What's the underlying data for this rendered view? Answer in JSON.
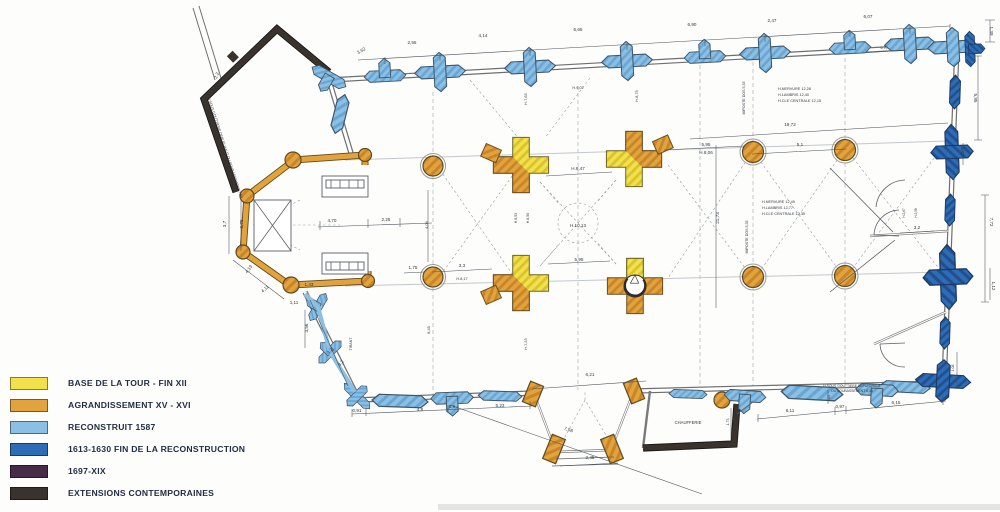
{
  "title": "Plan phasé d'une église (relevé archéologique)",
  "legend": {
    "items": [
      {
        "color": "#f2e14b",
        "label": "BASE DE LA TOUR - FIN XII"
      },
      {
        "color": "#e2a23c",
        "label": "AGRANDISSEMENT XV - XVI"
      },
      {
        "color": "#8bbfe3",
        "label": "RECONSTRUIT 1587"
      },
      {
        "color": "#2e6cb5",
        "label": "1613-1630 FIN DE LA RECONSTRUCTION"
      },
      {
        "color": "#472c48",
        "label": "1697-XIX"
      },
      {
        "color": "#39322d",
        "label": "EXTENSIONS CONTEMPORAINES"
      }
    ]
  },
  "plan": {
    "room_label": "CHAUFFERIE",
    "texts": [
      {
        "x": 362,
        "y": 52,
        "r": -30,
        "t": "3,52"
      },
      {
        "x": 412,
        "y": 44,
        "t": "2,55"
      },
      {
        "x": 483,
        "y": 37,
        "t": "4,14"
      },
      {
        "x": 578,
        "y": 31,
        "t": "6,65"
      },
      {
        "x": 692,
        "y": 26,
        "t": "6,90"
      },
      {
        "x": 772,
        "y": 22,
        "t": "2,47"
      },
      {
        "x": 868,
        "y": 18,
        "t": "6,07"
      },
      {
        "x": 990,
        "y": 31,
        "r": 90,
        "t": "1,39"
      },
      {
        "x": 974,
        "y": 98,
        "r": 90,
        "t": "5,95"
      },
      {
        "x": 218,
        "y": 76,
        "r": -68,
        "t": "2,2"
      },
      {
        "x": 224,
        "y": 148,
        "r": 72,
        "s": 3.6,
        "t": "H SOUS GOUTTIERE DEPUIS HAUT DU SOUBASSEMENT 7,80"
      },
      {
        "x": 790,
        "y": 126,
        "t": "19,72"
      },
      {
        "x": 800,
        "y": 146,
        "t": "5,1"
      },
      {
        "x": 961,
        "y": 152,
        "r": 90,
        "t": "1,02"
      },
      {
        "x": 990,
        "y": 222,
        "r": 90,
        "t": "7,72"
      },
      {
        "x": 917,
        "y": 229,
        "t": "3,2"
      },
      {
        "x": 992,
        "y": 286,
        "r": 90,
        "t": "1,12"
      },
      {
        "x": 778,
        "y": 90,
        "s": 3.8,
        "a": "s",
        "t": "H.NERVURE 12,28"
      },
      {
        "x": 778,
        "y": 96,
        "s": 3.8,
        "a": "s",
        "t": "H.LAMBRIS 12,40"
      },
      {
        "x": 778,
        "y": 102,
        "s": 3.8,
        "a": "s",
        "t": "H.CLE CENTRALE 12,15"
      },
      {
        "x": 762,
        "y": 203,
        "s": 3.8,
        "a": "s",
        "t": "H.NERVURE 12,49"
      },
      {
        "x": 762,
        "y": 209,
        "s": 3.8,
        "a": "s",
        "t": "H.LAMBRIS 12,77"
      },
      {
        "x": 762,
        "y": 215,
        "s": 3.8,
        "a": "s",
        "t": "H.CLE CENTRALE 12,35"
      },
      {
        "x": 745,
        "y": 98,
        "r": -90,
        "s": 3.6,
        "t": "IMPOSTE DOS 5,35"
      },
      {
        "x": 748,
        "y": 237,
        "r": -90,
        "s": 3.6,
        "t": "IMPOSTE DOS 5,35"
      },
      {
        "x": 578,
        "y": 170,
        "t": "H.8,47"
      },
      {
        "x": 578,
        "y": 227,
        "t": "H.10,13"
      },
      {
        "x": 579,
        "y": 261,
        "t": "5,95"
      },
      {
        "x": 706,
        "y": 146,
        "t": "5,95"
      },
      {
        "x": 706,
        "y": 154,
        "t": "H.8,06"
      },
      {
        "x": 719,
        "y": 218,
        "r": -90,
        "t": "21,73"
      },
      {
        "x": 517,
        "y": 218,
        "r": -90,
        "s": 3.6,
        "t": "H.8,53"
      },
      {
        "x": 529,
        "y": 218,
        "r": -90,
        "s": 3.6,
        "t": "H.8,50"
      },
      {
        "x": 527,
        "y": 99,
        "r": -90,
        "s": 3.8,
        "t": "H.7,63"
      },
      {
        "x": 638,
        "y": 96,
        "r": -90,
        "s": 3.8,
        "t": "H.8,75"
      },
      {
        "x": 578,
        "y": 89,
        "s": 3.8,
        "t": "H.9,02"
      },
      {
        "x": 332,
        "y": 222,
        "t": "4,70"
      },
      {
        "x": 386,
        "y": 221,
        "t": "2,25"
      },
      {
        "x": 428,
        "y": 225,
        "r": -90,
        "s": 3.8,
        "t": "4,05"
      },
      {
        "x": 413,
        "y": 269,
        "t": "1,75"
      },
      {
        "x": 462,
        "y": 267,
        "t": "3,3"
      },
      {
        "x": 462,
        "y": 280,
        "s": 3.8,
        "t": "H.8,17"
      },
      {
        "x": 226,
        "y": 224,
        "r": -90,
        "t": "3,7"
      },
      {
        "x": 243,
        "y": 224,
        "r": -90,
        "t": "2,76"
      },
      {
        "x": 250,
        "y": 270,
        "r": -55,
        "t": "4,13"
      },
      {
        "x": 266,
        "y": 290,
        "r": -42,
        "t": "4,11"
      },
      {
        "x": 309,
        "y": 286,
        "t": "1,43"
      },
      {
        "x": 294,
        "y": 304,
        "t": "1,11"
      },
      {
        "x": 308,
        "y": 328,
        "r": -90,
        "t": "3,56"
      },
      {
        "x": 331,
        "y": 352,
        "r": -48,
        "t": "3,2"
      },
      {
        "x": 342,
        "y": 364,
        "r": -48,
        "t": "3,2"
      },
      {
        "x": 357,
        "y": 412,
        "t": "0,91"
      },
      {
        "x": 420,
        "y": 411,
        "t": "4,8"
      },
      {
        "x": 452,
        "y": 408,
        "t": "0,9"
      },
      {
        "x": 500,
        "y": 407,
        "t": "5,23"
      },
      {
        "x": 568,
        "y": 431,
        "r": 18,
        "t": "7,58"
      },
      {
        "x": 590,
        "y": 376,
        "t": "6,21"
      },
      {
        "x": 590,
        "y": 459,
        "t": "2,45"
      },
      {
        "x": 688,
        "y": 424,
        "s": 4.2,
        "t": "CHAUFFERIE"
      },
      {
        "x": 729,
        "y": 422,
        "r": -90,
        "s": 3.6,
        "t": "1,73"
      },
      {
        "x": 352,
        "y": 344,
        "r": -90,
        "s": 3.6,
        "t": "TIRANT"
      },
      {
        "x": 790,
        "y": 412,
        "t": "6,11"
      },
      {
        "x": 840,
        "y": 408,
        "t": "0,97"
      },
      {
        "x": 896,
        "y": 404,
        "t": "6,15"
      },
      {
        "x": 954,
        "y": 368,
        "r": -90,
        "s": 3.6,
        "t": "1,08"
      },
      {
        "x": 830,
        "y": 398,
        "r": -90,
        "s": 3.2,
        "t": "1,05"
      },
      {
        "x": 852,
        "y": 387,
        "s": 3.4,
        "t": "H SOUS GOUTTIERE DEPUIS HAUT"
      },
      {
        "x": 852,
        "y": 392,
        "s": 3.4,
        "t": "DU SOUBASSEMENT 8,44"
      },
      {
        "x": 884,
        "y": 49,
        "s": 3.6,
        "t": "6,70"
      },
      {
        "x": 527,
        "y": 344,
        "r": -90,
        "s": 3.8,
        "t": "H.7,23"
      },
      {
        "x": 430,
        "y": 330,
        "r": -90,
        "s": 3.8,
        "t": "8,45"
      },
      {
        "x": 905,
        "y": 213,
        "r": -90,
        "s": 3.2,
        "t": "H.2,67"
      },
      {
        "x": 917,
        "y": 213,
        "r": -90,
        "s": 3.2,
        "t": "H.2,58"
      }
    ]
  }
}
